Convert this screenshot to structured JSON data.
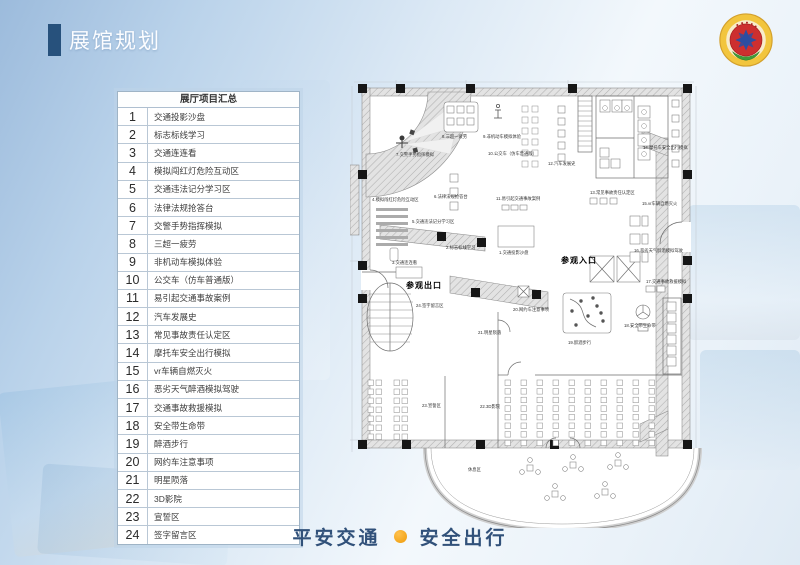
{
  "slide": {
    "title": "展馆规划",
    "footer": {
      "left_text": "平安交通",
      "right_text": "安全出行"
    }
  },
  "table": {
    "header": "展厅项目汇总",
    "rows": [
      {
        "num": "1",
        "label": "交通投影沙盘"
      },
      {
        "num": "2",
        "label": "标志标线学习"
      },
      {
        "num": "3",
        "label": "交通连连看"
      },
      {
        "num": "4",
        "label": "模拟闯红灯危险互动区"
      },
      {
        "num": "5",
        "label": "交通违法记分学习区"
      },
      {
        "num": "6",
        "label": "法律法规抢答台"
      },
      {
        "num": "7",
        "label": "交警手势指挥模拟"
      },
      {
        "num": "8",
        "label": "三超一疲劳"
      },
      {
        "num": "9",
        "label": "非机动车模拟体验"
      },
      {
        "num": "10",
        "label": "公交车（仿车普通版）"
      },
      {
        "num": "11",
        "label": "易引起交通事故案例"
      },
      {
        "num": "12",
        "label": "汽车发展史"
      },
      {
        "num": "13",
        "label": "常见事故责任认定区"
      },
      {
        "num": "14",
        "label": "摩托车安全出行模拟"
      },
      {
        "num": "15",
        "label": "vr车辆自燃灭火"
      },
      {
        "num": "16",
        "label": "恶劣天气醉酒模拟驾驶"
      },
      {
        "num": "17",
        "label": "交通事故救援模拟"
      },
      {
        "num": "18",
        "label": "安全带生命带"
      },
      {
        "num": "19",
        "label": "醉酒步行"
      },
      {
        "num": "20",
        "label": "网约车注意事项"
      },
      {
        "num": "21",
        "label": "明星陨落"
      },
      {
        "num": "22",
        "label": "3D影院"
      },
      {
        "num": "23",
        "label": "宣誓区"
      },
      {
        "num": "24",
        "label": "签字留言区"
      }
    ]
  },
  "plan": {
    "labels": [
      {
        "text": "参观入口",
        "x": 211,
        "y": 183,
        "bold": true,
        "name": "plan-entrance-label"
      },
      {
        "text": "参观出口",
        "x": 56,
        "y": 208,
        "bold": true,
        "name": "plan-exit-label"
      },
      {
        "text": "1.交通投影沙盘",
        "x": 149,
        "y": 174
      },
      {
        "text": "2.标志标线学习",
        "x": 96,
        "y": 169
      },
      {
        "text": "3.交通连连看",
        "x": 42,
        "y": 184
      },
      {
        "text": "4.模拟闯红灯危险互动区",
        "x": 22,
        "y": 121
      },
      {
        "text": "5.交通违法记分学习区",
        "x": 62,
        "y": 143
      },
      {
        "text": "6.法律法规抢答台",
        "x": 84,
        "y": 118
      },
      {
        "text": "7.交警手势指挥模拟",
        "x": 46,
        "y": 76
      },
      {
        "text": "8.三超一疲劳",
        "x": 92,
        "y": 58
      },
      {
        "text": "9.非机动车模拟体验",
        "x": 133,
        "y": 58
      },
      {
        "text": "10.公交车（仿车普通版）",
        "x": 138,
        "y": 75
      },
      {
        "text": "11.易引起交通事故案例",
        "x": 146,
        "y": 120
      },
      {
        "text": "12.汽车发展史",
        "x": 198,
        "y": 85
      },
      {
        "text": "13.常见事故责任认定区",
        "x": 240,
        "y": 114
      },
      {
        "text": "14.摩托车安全出行模拟",
        "x": 293,
        "y": 69
      },
      {
        "text": "15.vr车辆自燃灭火",
        "x": 292,
        "y": 125
      },
      {
        "text": "16.恶劣天气醉酒模拟驾驶",
        "x": 284,
        "y": 172
      },
      {
        "text": "17.交通事故救援模拟",
        "x": 296,
        "y": 203
      },
      {
        "text": "18.安全带生命带",
        "x": 274,
        "y": 247
      },
      {
        "text": "19.醉酒步行",
        "x": 218,
        "y": 264
      },
      {
        "text": "20.网约车注意事项",
        "x": 163,
        "y": 231
      },
      {
        "text": "21.明星陨落",
        "x": 128,
        "y": 254
      },
      {
        "text": "22.3D影院",
        "x": 130,
        "y": 328
      },
      {
        "text": "23.宣誓区",
        "x": 72,
        "y": 327
      },
      {
        "text": "24.签字留言区",
        "x": 66,
        "y": 227
      },
      {
        "text": "休息区",
        "x": 118,
        "y": 391
      }
    ]
  },
  "colors": {
    "title_marker": "#27517c",
    "title_text": "#fcfdff",
    "footer_text": "#31517a",
    "footer_dot": "#ee9b0a",
    "table_border": "#9fb4c6",
    "wall_hatch": "#b0b0b0",
    "column_black": "#161616"
  }
}
